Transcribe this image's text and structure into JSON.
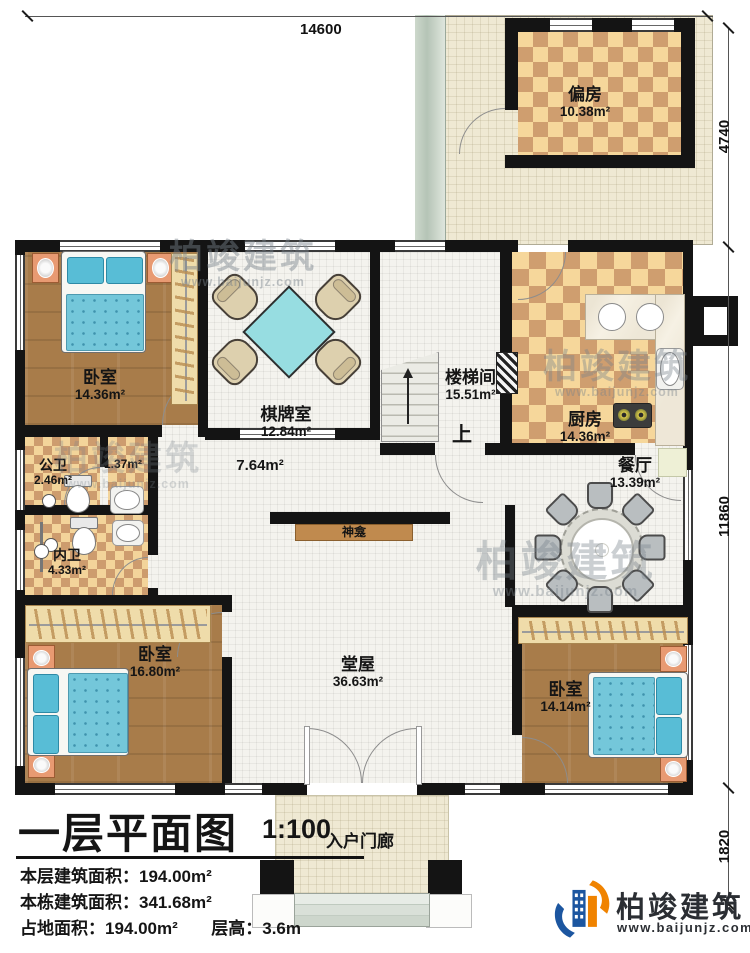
{
  "dimensions": {
    "top": "14600",
    "right_top": "4740",
    "right_middle": "11860",
    "right_bottom": "1820"
  },
  "rooms": {
    "pianfang": {
      "name": "偏房",
      "area": "10.38m²"
    },
    "bedroom1": {
      "name": "卧室",
      "area": "14.36m²"
    },
    "qipaishi": {
      "name": "棋牌室",
      "area": "12.84m²"
    },
    "loutijian": {
      "name": "楼梯间",
      "area": "15.51m²"
    },
    "kitchen": {
      "name": "厨房",
      "area": "14.36m²"
    },
    "gongwei": {
      "name": "公卫",
      "area": "2.46m²"
    },
    "washarea": {
      "area": "1.37m²"
    },
    "neiwei": {
      "name": "内卫",
      "area": "4.33m²"
    },
    "corridor": {
      "area": "7.64m²"
    },
    "dining": {
      "name": "餐厅",
      "area": "13.39m²"
    },
    "bedroom2": {
      "name": "卧室",
      "area": "16.80m²"
    },
    "tangwu": {
      "name": "堂屋",
      "area": "36.63m²"
    },
    "bedroom3": {
      "name": "卧室",
      "area": "14.14m²"
    },
    "porch": {
      "name": "入户门廊"
    },
    "shrine": {
      "name": "神龛"
    },
    "stair_up": "上"
  },
  "title_block": {
    "title": "一层平面图",
    "scale": "1:100",
    "row1_label": "本层建筑面积：",
    "row1_value": "194.00m²",
    "row2_label": "本栋建筑面积：",
    "row2_value": "341.68m²",
    "row3_label": "占地面积：",
    "row3_value": "194.00m²",
    "row4_label": "层高：",
    "row4_value": "3.6m"
  },
  "branding": {
    "name": "柏竣建筑",
    "url": "www.baijunjz.com"
  },
  "watermark": {
    "name": "柏竣建筑",
    "url": "www.baijunjz.com"
  },
  "colors": {
    "wall": "#141414",
    "wood_floor": "#a87c4a",
    "checker_light": "#f6d79b",
    "checker_dark": "#cf9e6f",
    "bed_blue": "#74c7da",
    "logo_blue": "#1c56a0",
    "logo_orange": "#f08300"
  }
}
